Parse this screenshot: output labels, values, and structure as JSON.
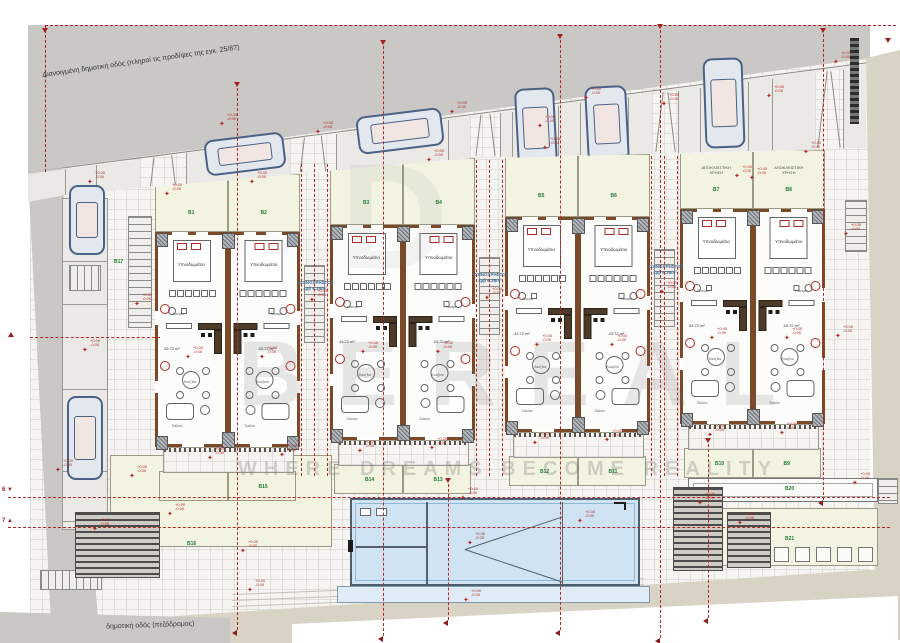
{
  "annotations": {
    "top_road_label": "Διανοιγμένη δημοτική οδός (πληροί τις προδ/ψες της εγκ. 25/87)",
    "bottom_road_label": "δημοτική οδός (πεζόδρομος)",
    "common_area_title": "ΚΟΙΝΟΧΡΗΣΤΟΣ",
    "common_area_sub": "εμβ 6.38m²",
    "exclusive_use_line1": "ΑΠΟΚΛΕΙΣΤΙΚΗ",
    "exclusive_use_line2": "ΧΡΗΣΗ",
    "level_plus": "+0.00",
    "level_minus": "-0.00",
    "unit_area": "43.72 m²",
    "section_marker_6": "6",
    "section_marker_7": "7"
  },
  "rooms": {
    "bedroom": "Υπνοδωμάτιο",
    "bath": "Λουτρό",
    "kitchen": "Κουζίνα",
    "living": "Σαλόνι"
  },
  "gardens": {
    "front": [
      "B1",
      "B2",
      "B3",
      "B4",
      "B5",
      "B6",
      "B7",
      "B8"
    ],
    "rear": [
      "",
      "B15",
      "B14",
      "B13",
      "B12",
      "B11",
      "B10",
      "B9"
    ],
    "left_court": "B17",
    "big_left": "B16",
    "planter": "B20",
    "bottom_right": "B21"
  },
  "watermark": {
    "brand": "BEREAL",
    "tagline": "WHERE DREAMS BECOME REALITY",
    "ghost_letter": "D"
  },
  "colors": {
    "annotation_red": "#b02a25",
    "garden_green": "#1d7d34",
    "common_blue": "#3a6fa0",
    "road_gray": "#c9c8c4",
    "road_beige": "#d9d3c5",
    "pool_blue": "#cfe3f3",
    "wall_brown": "#7a4a28"
  }
}
